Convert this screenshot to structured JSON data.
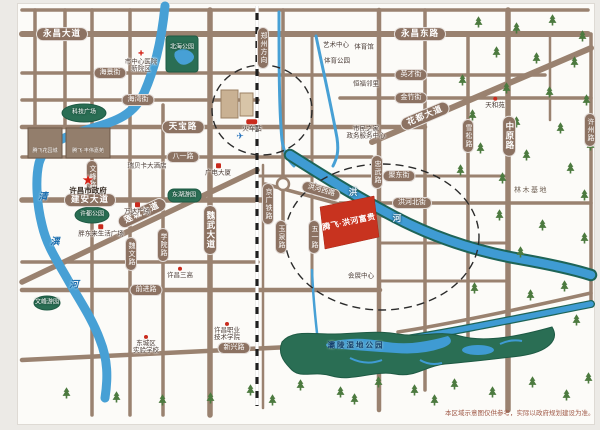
{
  "map": {
    "project": {
      "name": "腾飞·洪河富贵"
    },
    "disclaimer": "本区域示意图仅供参考，实际以政府规划建设为准。",
    "colors": {
      "road": "#9a8270",
      "river": "#3f9bd3",
      "river_edge": "#1e6457",
      "park": "#2a6e54",
      "project_block": "#c8331f",
      "marker_red": "#c92a1c"
    },
    "labels": [
      {
        "name": "yongchang-avenue-label",
        "text": "永昌大道",
        "x": 62,
        "y": 34,
        "style": "pill-lg"
      },
      {
        "name": "yongchang-east-road-label",
        "text": "永昌东路",
        "x": 420,
        "y": 34,
        "style": "pill-lg"
      },
      {
        "name": "haijing-street-label",
        "text": "海景街",
        "x": 110,
        "y": 73,
        "style": "pill"
      },
      {
        "name": "haiwan-street-label",
        "text": "海湾街",
        "x": 138,
        "y": 100,
        "style": "pill"
      },
      {
        "name": "tianbao-road-label",
        "text": "天宝路",
        "x": 183,
        "y": 127,
        "style": "pill-lg"
      },
      {
        "name": "bayi-road-label",
        "text": "八一路",
        "x": 183,
        "y": 157,
        "style": "pill"
      },
      {
        "name": "jianan-avenue-label",
        "text": "建安大道",
        "x": 90,
        "y": 200,
        "style": "pill-lg"
      },
      {
        "name": "liancheng-avenue-label",
        "text": "莲城大道",
        "x": 142,
        "y": 213,
        "style": "pill-lg",
        "rot": -25
      },
      {
        "name": "qianjin-road-label",
        "text": "前进路",
        "x": 146,
        "y": 290,
        "style": "pill"
      },
      {
        "name": "xinxing-road-label",
        "text": "新兴路",
        "x": 234,
        "y": 348,
        "style": "pill"
      },
      {
        "name": "yingcai-street-label",
        "text": "英才街",
        "x": 411,
        "y": 75,
        "style": "pill"
      },
      {
        "name": "jinzhu-street-label",
        "text": "金竹街",
        "x": 411,
        "y": 98,
        "style": "pill"
      },
      {
        "name": "judong-street-label",
        "text": "聚东街",
        "x": 399,
        "y": 176,
        "style": "pill"
      },
      {
        "name": "honghe-north-street-label",
        "text": "洪河北街",
        "x": 412,
        "y": 203,
        "style": "pill"
      },
      {
        "name": "huadu-avenue-label",
        "text": "花都大道",
        "x": 425,
        "y": 116,
        "style": "pill-lg",
        "rot": -23
      },
      {
        "name": "honghe-west-road-label",
        "text": "洪河西路",
        "x": 321,
        "y": 191,
        "style": "pill",
        "rot": 16
      },
      {
        "name": "wenfeng-road-label",
        "text": "文峰路",
        "x": 92,
        "y": 177,
        "style": "vpill"
      },
      {
        "name": "weiwen-road-label",
        "text": "魏文路",
        "x": 131,
        "y": 254,
        "style": "vpill"
      },
      {
        "name": "xueyuan-road-label",
        "text": "学院路",
        "x": 163,
        "y": 245,
        "style": "vpill"
      },
      {
        "name": "weiwu-avenue-label",
        "text": "魏武大道",
        "x": 210,
        "y": 230,
        "style": "vpill-lg"
      },
      {
        "name": "zhongwu-road-label",
        "text": "忠武路",
        "x": 377,
        "y": 172,
        "style": "vpill"
      },
      {
        "name": "yuquan-road-label",
        "text": "玉泉路",
        "x": 281,
        "y": 237,
        "style": "vpill"
      },
      {
        "name": "wuyi-road-label",
        "text": "五一路",
        "x": 314,
        "y": 237,
        "style": "vpill"
      },
      {
        "name": "xuesong-road-label",
        "text": "雪松路",
        "x": 468,
        "y": 136,
        "style": "vpill"
      },
      {
        "name": "zhongyuan-road-label",
        "text": "中原路",
        "x": 509,
        "y": 136,
        "style": "vpill-lg"
      },
      {
        "name": "xuzhou-road-label",
        "text": "许州路",
        "x": 590,
        "y": 130,
        "style": "vpill"
      },
      {
        "name": "zhengzhou-direction-label",
        "text": "郑州方向",
        "x": 263,
        "y": 48,
        "style": "vpill"
      },
      {
        "name": "jingguang-railway-label",
        "text": "京广铁路",
        "x": 268,
        "y": 204,
        "style": "vpill"
      },
      {
        "name": "beihai-park-label",
        "text": "北海公园",
        "x": 182,
        "y": 48,
        "style": "parklbl"
      },
      {
        "name": "keji-square-label",
        "text": "科技广场",
        "x": 84,
        "y": 113,
        "style": "parklbl"
      },
      {
        "name": "xudu-park-label",
        "text": "许都公园",
        "x": 92,
        "y": 215,
        "style": "parklbl"
      },
      {
        "name": "donghu-garden-label",
        "text": "东湖游园",
        "x": 184,
        "y": 196,
        "style": "parklbl"
      },
      {
        "name": "wenfeng-garden-label",
        "text": "文峰游园",
        "x": 47,
        "y": 303,
        "style": "parklbl"
      },
      {
        "name": "city-central-hospital-label",
        "text": "市中心医院\n新院区",
        "x": 141,
        "y": 62,
        "style": "place",
        "marker": "cross"
      },
      {
        "name": "xuchang-city-government-label",
        "text": "许昌市政府",
        "x": 88,
        "y": 185,
        "style": "place-strong",
        "marker": "star"
      },
      {
        "name": "wanda-plaza-label",
        "text": "万达广场",
        "x": 137,
        "y": 209,
        "style": "place",
        "marker": "sq"
      },
      {
        "name": "pangdonglai-plaza-label",
        "text": "胖东来生活广场",
        "x": 101,
        "y": 231,
        "style": "place",
        "marker": "sq"
      },
      {
        "name": "ruibeika-hotel-label",
        "text": "瑞贝卡大酒店",
        "x": 147,
        "y": 166,
        "style": "place"
      },
      {
        "name": "guangdian-tower-label",
        "text": "广电大厦",
        "x": 218,
        "y": 170,
        "style": "place",
        "marker": "sq"
      },
      {
        "name": "railway-station-label",
        "text": "火车站",
        "x": 252,
        "y": 126,
        "style": "place",
        "marker": "train"
      },
      {
        "name": "air-ticket-office-icon",
        "text": "",
        "x": 240,
        "y": 137,
        "style": "place",
        "marker": "plane"
      },
      {
        "name": "art-center-label",
        "text": "艺术中心",
        "x": 336,
        "y": 45,
        "style": "place"
      },
      {
        "name": "gymnasium-label",
        "text": "体育馆",
        "x": 364,
        "y": 47,
        "style": "place"
      },
      {
        "name": "sports-park-label",
        "text": "体育公园",
        "x": 337,
        "y": 61,
        "style": "place"
      },
      {
        "name": "hengfu-linli-label",
        "text": "恒福邻里",
        "x": 366,
        "y": 84,
        "style": "place"
      },
      {
        "name": "tianheyuan-label",
        "text": "天和苑",
        "x": 495,
        "y": 103,
        "style": "place",
        "marker": "dot"
      },
      {
        "name": "citizens-home-label",
        "text": "市民之家\n政务服务中心",
        "x": 366,
        "y": 133,
        "style": "place"
      },
      {
        "name": "convention-center-label",
        "text": "会展中心",
        "x": 361,
        "y": 276,
        "style": "place"
      },
      {
        "name": "no3-high-school-label",
        "text": "许昌三高",
        "x": 180,
        "y": 273,
        "style": "place",
        "marker": "dot"
      },
      {
        "name": "dongcheng-experimental-school-label",
        "text": "东城区\n实验学校",
        "x": 146,
        "y": 345,
        "style": "place",
        "marker": "dot"
      },
      {
        "name": "vocational-college-label",
        "text": "许昌职业\n技术学院",
        "x": 227,
        "y": 332,
        "style": "place",
        "marker": "dot"
      },
      {
        "name": "linmu-base-label",
        "text": "林木基地",
        "x": 531,
        "y": 191,
        "style": "area"
      },
      {
        "name": "baling-wetland-park-label",
        "text": "灞陵湿地公园",
        "x": 356,
        "y": 346,
        "style": "wetlbl"
      },
      {
        "name": "qingyi-river-char-1",
        "text": "清",
        "x": 43,
        "y": 198,
        "style": "wchar"
      },
      {
        "name": "qingyi-river-char-2",
        "text": "潩",
        "x": 55,
        "y": 243,
        "style": "wchar"
      },
      {
        "name": "qingyi-river-char-3",
        "text": "河",
        "x": 74,
        "y": 286,
        "style": "wchar"
      },
      {
        "name": "honghe-river-char-1",
        "text": "洪",
        "x": 353,
        "y": 193,
        "style": "wchar-w"
      },
      {
        "name": "honghe-river-char-2",
        "text": "河",
        "x": 397,
        "y": 219,
        "style": "wchar-w"
      },
      {
        "name": "tengfei-garden-city-label",
        "text": "腾飞花园城",
        "x": 45,
        "y": 152,
        "style": "bldg"
      },
      {
        "name": "tengfei-fengwei-jiayuan-label",
        "text": "腾飞·丰伟嘉苑",
        "x": 88,
        "y": 152,
        "style": "bldg"
      }
    ]
  }
}
